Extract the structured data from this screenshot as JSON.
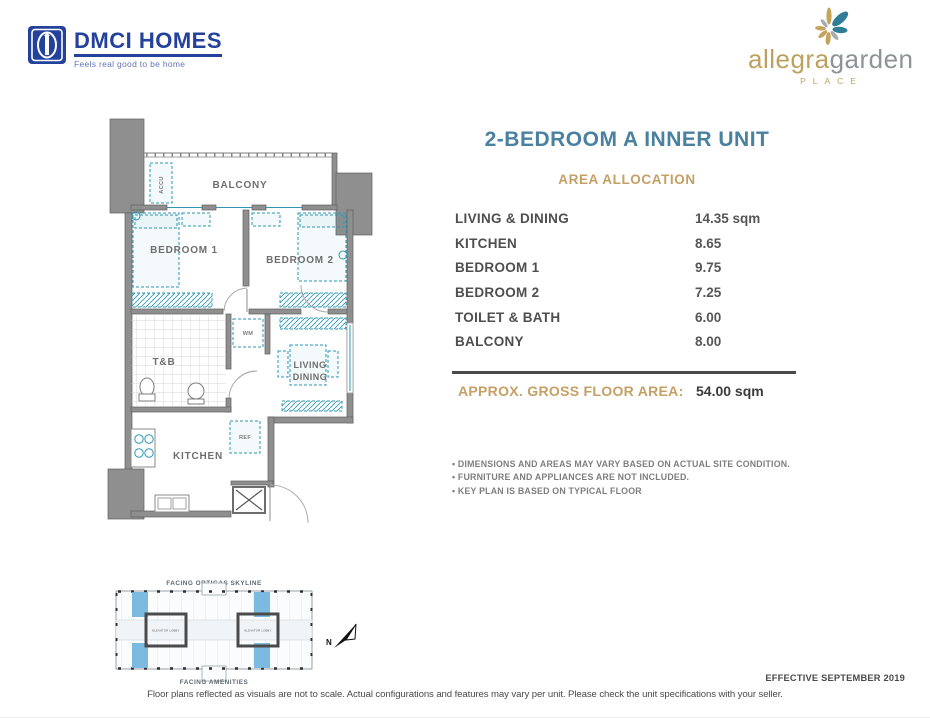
{
  "header": {
    "dmci_name": "DMCI HOMES",
    "dmci_tagline": "Feels real good to be home",
    "brand_word1": "allegra",
    "brand_word2": "garden",
    "brand_sub": "PLACE"
  },
  "unit": {
    "title": "2-BEDROOM A INNER UNIT",
    "section_title": "AREA ALLOCATION",
    "areas": [
      {
        "label": "LIVING & DINING",
        "value": "14.35 sqm"
      },
      {
        "label": "KITCHEN",
        "value": "8.65"
      },
      {
        "label": "BEDROOM 1",
        "value": "9.75"
      },
      {
        "label": "BEDROOM 2",
        "value": "7.25"
      },
      {
        "label": "TOILET & BATH",
        "value": "6.00"
      },
      {
        "label": "BALCONY",
        "value": "8.00"
      }
    ],
    "gross_label": "APPROX. GROSS FLOOR AREA:",
    "gross_value": "54.00 sqm",
    "notes": [
      "• DIMENSIONS AND AREAS MAY VARY BASED ON ACTUAL SITE CONDITION.",
      "• FURNITURE AND APPLIANCES ARE NOT INCLUDED.",
      "• KEY PLAN IS BASED ON TYPICAL FLOOR"
    ]
  },
  "floorplan": {
    "labels": {
      "balcony": "BALCONY",
      "bedroom1": "BEDROOM 1",
      "bedroom2": "BEDROOM 2",
      "tb": "T&B",
      "living": "LIVING",
      "dining": "DINING",
      "kitchen": "KITCHEN",
      "accu": "ACCU",
      "wm": "WM",
      "ref": "REF"
    }
  },
  "keyplan": {
    "top_label": "FACING ORTIGAS SKYLINE",
    "bottom_label": "FACING AMENITIES",
    "lobby_label": "ELEVATOR LOBBY",
    "north": "N"
  },
  "footer": {
    "effective": "EFFECTIVE SEPTEMBER 2019",
    "disclaimer": "Floor plans reflected as visuals are not to scale. Actual configurations and features may vary per unit. Please check the unit specifications with your seller."
  },
  "colors": {
    "title_teal": "#4a80a0",
    "accent_gold": "#c5a065",
    "dmci_blue": "#24429c",
    "wall_gray": "#8f8f8f",
    "furniture_teal": "#2e96b4",
    "keyplan_unit_blue": "#6fb3de"
  }
}
